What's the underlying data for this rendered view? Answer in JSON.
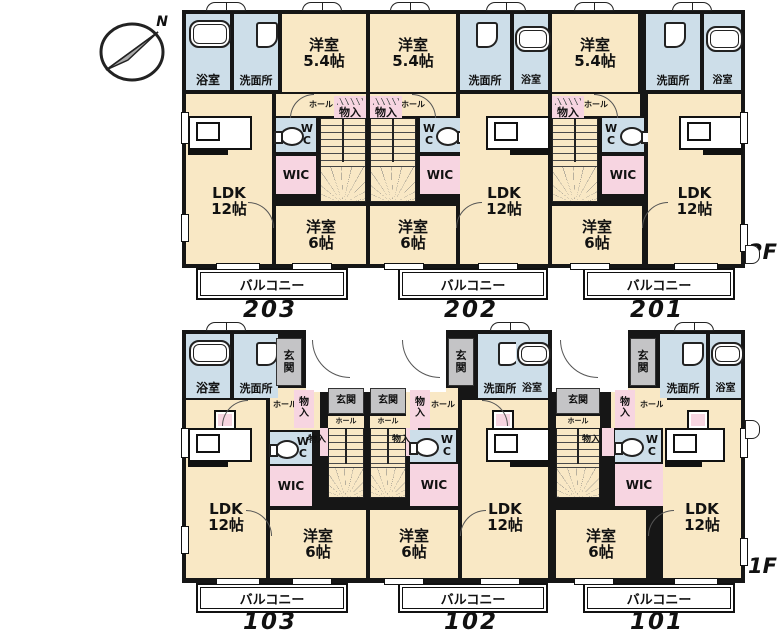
{
  "compass": {
    "north": "N"
  },
  "labels": {
    "bath": "浴室",
    "wash": "洗面所",
    "west_5_4": "洋室\n5.4帖",
    "west_6": "洋室\n6帖",
    "ldk_12": "LDK\n12帖",
    "wc": "W\nC",
    "wic": "WIC",
    "storage": "物入",
    "storage_v": "物\n入",
    "hall": "ホール",
    "entrance": "玄関",
    "entrance_v": "玄\n関",
    "balcony": "バルコニー"
  },
  "floor_2f": {
    "label": "2F",
    "unit_numbers": [
      "203",
      "202",
      "201"
    ]
  },
  "floor_1f": {
    "label": "1F",
    "unit_numbers": [
      "103",
      "102",
      "101"
    ]
  },
  "colors": {
    "room_cream": "#f9e8c5",
    "wet_blue": "#cddee9",
    "closet_pink": "#f7d5e1",
    "entrance_gray": "#c4c4c6",
    "wall": "#161616"
  }
}
